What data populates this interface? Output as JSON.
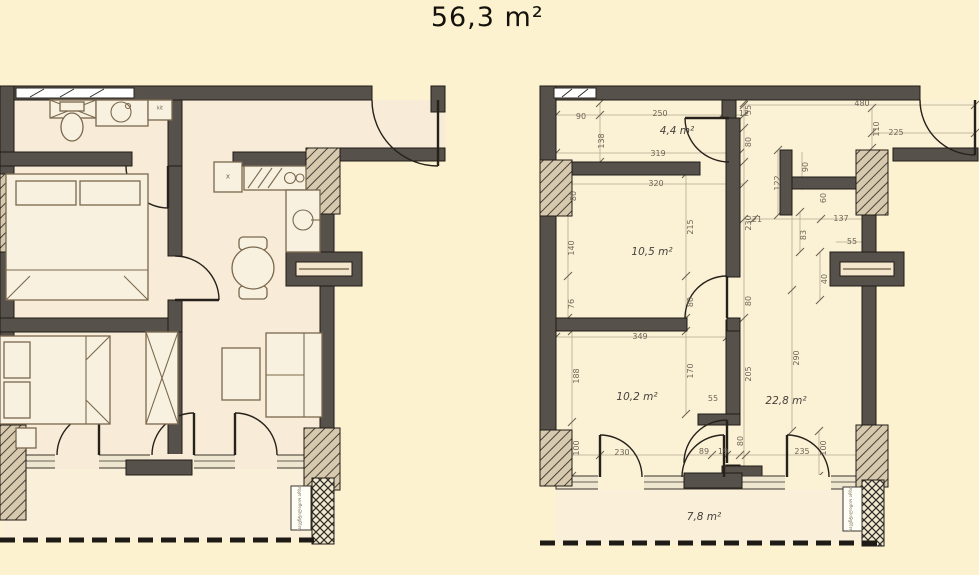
{
  "title": "56,3 m²",
  "colors": {
    "background": "#FCF2CF",
    "wall": "#57514B",
    "floor_left": "#F8ECD8",
    "floor_right": "#FBF2D6",
    "dim_text": "#6E6557"
  },
  "left_plan": {
    "labels": [
      {
        "t": "x",
        "x": 228,
        "y": 177,
        "s": 7,
        "n": "fridge-x-label"
      },
      {
        "t": "kit",
        "x": 160,
        "y": 109,
        "s": 5,
        "n": "boiler-label"
      },
      {
        "t": "სავენტილაციო არხი",
        "x": 301,
        "y": 508,
        "r": -90,
        "s": 4.5,
        "n": "shaft-label"
      }
    ]
  },
  "right_plan": {
    "area_labels": [
      {
        "t": "4,4 m²",
        "x": 677,
        "y": 131,
        "n": "area-hall"
      },
      {
        "t": "10,5 m²",
        "x": 652,
        "y": 252,
        "n": "area-bedroom-1"
      },
      {
        "t": "10,2 m²",
        "x": 637,
        "y": 397,
        "n": "area-bedroom-2"
      },
      {
        "t": "22,8 m²",
        "x": 786,
        "y": 401,
        "n": "area-living"
      },
      {
        "t": "7,8 m²",
        "x": 704,
        "y": 517,
        "n": "area-balcony"
      }
    ],
    "dimensions": [
      {
        "t": "90",
        "x": 581,
        "y": 117
      },
      {
        "t": "250",
        "x": 660,
        "y": 114
      },
      {
        "t": "12",
        "x": 744,
        "y": 114
      },
      {
        "t": "138",
        "x": 602,
        "y": 141,
        "r": -90
      },
      {
        "t": "319",
        "x": 658,
        "y": 154
      },
      {
        "t": "320",
        "x": 656,
        "y": 184
      },
      {
        "t": "55",
        "x": 749,
        "y": 110,
        "r": -90
      },
      {
        "t": "80",
        "x": 749,
        "y": 142,
        "r": -90
      },
      {
        "t": "230",
        "x": 749,
        "y": 223,
        "r": -90
      },
      {
        "t": "122",
        "x": 778,
        "y": 183,
        "r": -90
      },
      {
        "t": "480",
        "x": 862,
        "y": 104
      },
      {
        "t": "110",
        "x": 877,
        "y": 129,
        "r": -90
      },
      {
        "t": "225",
        "x": 896,
        "y": 133
      },
      {
        "t": "90",
        "x": 806,
        "y": 167,
        "r": -90
      },
      {
        "t": "60",
        "x": 824,
        "y": 198,
        "r": -90
      },
      {
        "t": "21",
        "x": 757,
        "y": 220
      },
      {
        "t": "137",
        "x": 841,
        "y": 219
      },
      {
        "t": "83",
        "x": 804,
        "y": 235,
        "r": -90
      },
      {
        "t": "55",
        "x": 852,
        "y": 242
      },
      {
        "t": "40",
        "x": 825,
        "y": 279,
        "r": -90
      },
      {
        "t": "80",
        "x": 574,
        "y": 196,
        "r": -90
      },
      {
        "t": "140",
        "x": 572,
        "y": 248,
        "r": -90
      },
      {
        "t": "76",
        "x": 572,
        "y": 304,
        "r": -90
      },
      {
        "t": "215",
        "x": 691,
        "y": 227,
        "r": -90
      },
      {
        "t": "80",
        "x": 691,
        "y": 302,
        "r": -90
      },
      {
        "t": "80",
        "x": 749,
        "y": 301,
        "r": -90
      },
      {
        "t": "349",
        "x": 640,
        "y": 337
      },
      {
        "t": "188",
        "x": 577,
        "y": 376,
        "r": -90
      },
      {
        "t": "170",
        "x": 691,
        "y": 371,
        "r": -90
      },
      {
        "t": "205",
        "x": 749,
        "y": 374,
        "r": -90
      },
      {
        "t": "290",
        "x": 797,
        "y": 358,
        "r": -90
      },
      {
        "t": "55",
        "x": 713,
        "y": 399
      },
      {
        "t": "100",
        "x": 577,
        "y": 448,
        "r": -90
      },
      {
        "t": "230",
        "x": 622,
        "y": 453
      },
      {
        "t": "89",
        "x": 704,
        "y": 452
      },
      {
        "t": "19",
        "x": 723,
        "y": 452
      },
      {
        "t": "80",
        "x": 741,
        "y": 441,
        "r": -90
      },
      {
        "t": "235",
        "x": 802,
        "y": 452
      },
      {
        "t": "100",
        "x": 824,
        "y": 448,
        "r": -90
      }
    ],
    "labels": [
      {
        "t": "სავენტილაციო არხი",
        "x": 852,
        "y": 509,
        "r": -90,
        "s": 4.5,
        "n": "shaft-label"
      }
    ]
  }
}
